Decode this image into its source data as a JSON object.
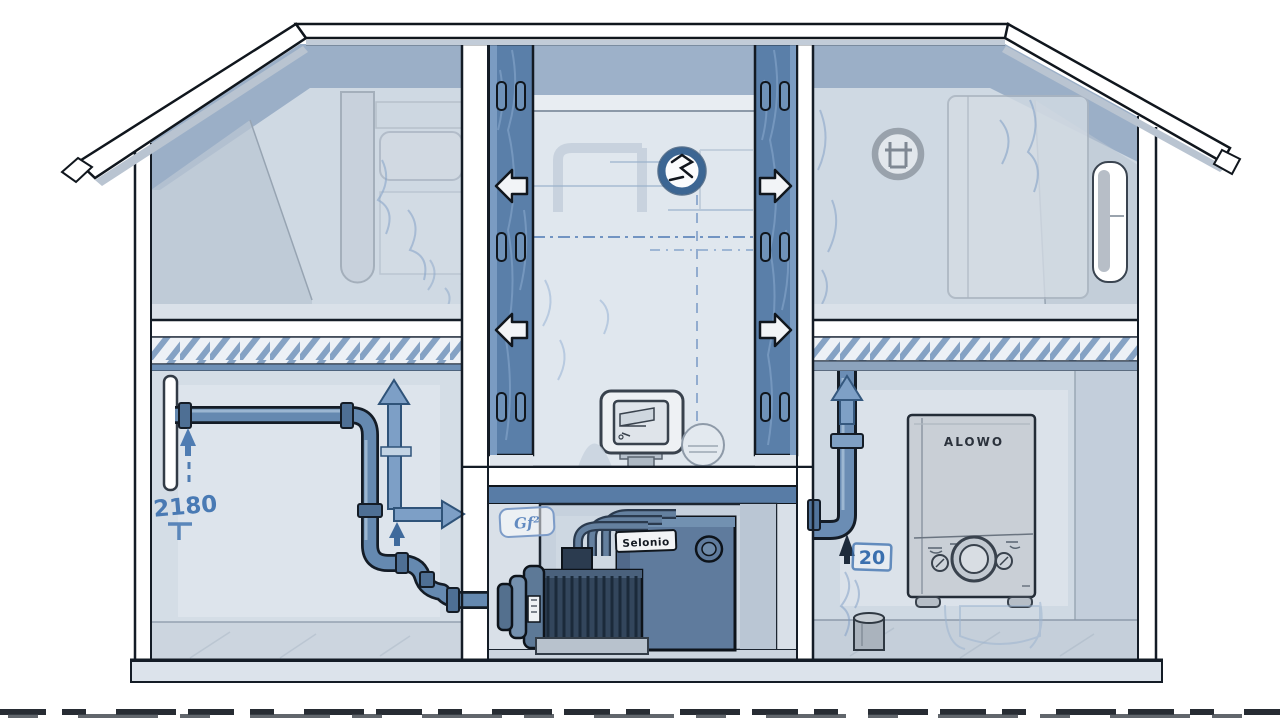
{
  "scene": {
    "title": "house-water-circulation-cutaway-illustration",
    "labels": {
      "boiler_brand": "ALOWO",
      "pump_brand": "Selonio",
      "riser_value": "20",
      "supply_annotation": "2180",
      "pump_wall_tag": "Gf²"
    },
    "icons": [
      {
        "name": "fan-valve-icon",
        "shape": "dark ring with scribble glyph, center of upper middle room"
      },
      {
        "name": "attic-emblem-icon",
        "shape": "gray ring stamp with bar glyph, upper right room"
      },
      {
        "name": "duct-flow-left-arrow",
        "shape": "white outlined arrow in left duct, two instances"
      },
      {
        "name": "duct-flow-right-arrow",
        "shape": "white outlined arrow in right duct, two instances"
      },
      {
        "name": "flow-up-arrow",
        "shape": "blue up arrows over pipes"
      },
      {
        "name": "flow-right-arrow",
        "shape": "blue elbow arrow in lower left room"
      }
    ],
    "colors": {
      "outline": "#141c26",
      "wall_fill": "#cfd9e3",
      "ceiling_band": "#9bafc7",
      "duct_blue": "#5a7fa9",
      "pipe_blue": "#6589b0",
      "pump_housing": "#5f7b9d",
      "motor_dark": "#33465c",
      "boiler_gray": "#c9cfd6",
      "annotation_blue": "#3a6fae",
      "arrow_white": "#f2f4f7"
    }
  }
}
